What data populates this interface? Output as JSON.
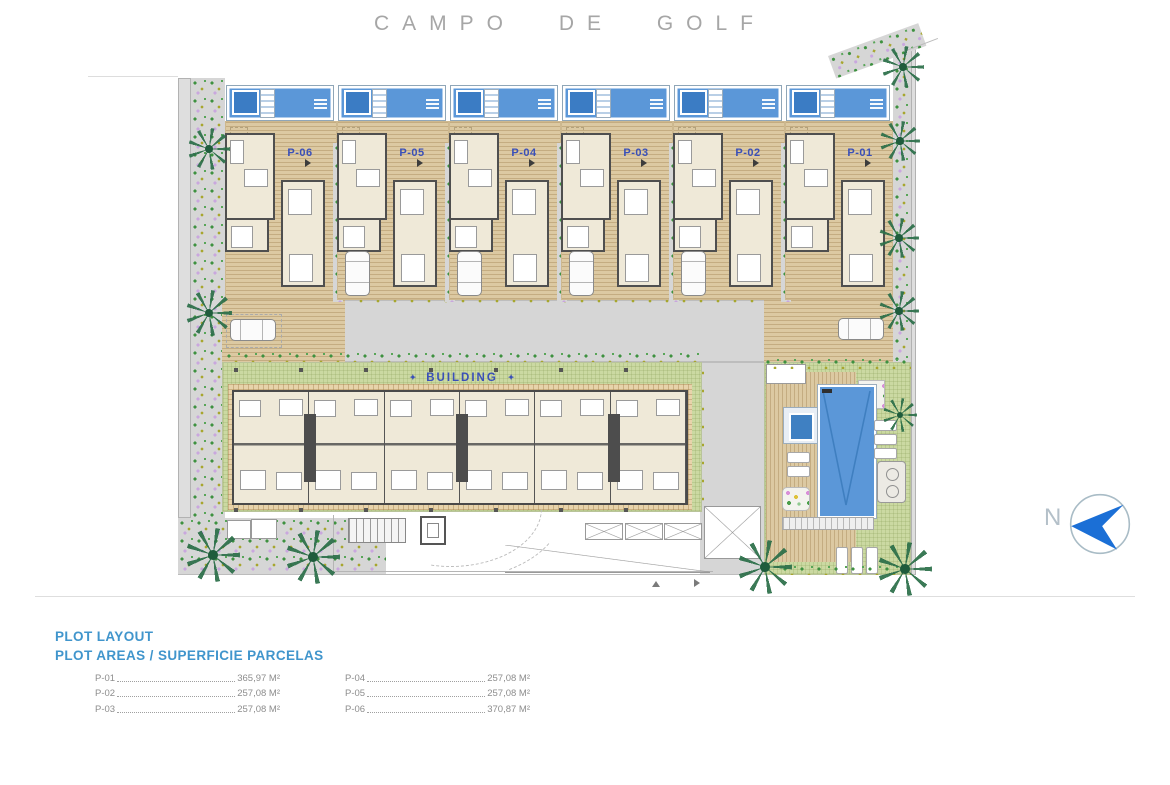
{
  "title": "CAMPO DE GOLF",
  "plots": [
    {
      "label": "P-06",
      "mods": [
        "no-car"
      ]
    },
    {
      "label": "P-05",
      "mods": []
    },
    {
      "label": "P-04",
      "mods": []
    },
    {
      "label": "P-03",
      "mods": []
    },
    {
      "label": "P-02",
      "mods": []
    },
    {
      "label": "P-01",
      "mods": [
        "no-car"
      ]
    }
  ],
  "building": {
    "label": "BUILDING",
    "decor": "✦"
  },
  "north": {
    "label": "N"
  },
  "legend": {
    "title": "PLOT LAYOUT",
    "subtitle": "PLOT AREAS / SUPERFICIE PARCELAS",
    "col1": [
      {
        "label": "P-01",
        "value": "365,97 M²"
      },
      {
        "label": "P-02",
        "value": "257,08 M²"
      },
      {
        "label": "P-03",
        "value": "257,08 M²"
      }
    ],
    "col2": [
      {
        "label": "P-04",
        "value": "257,08 M²"
      },
      {
        "label": "P-05",
        "value": "257,08 M²"
      },
      {
        "label": "P-06",
        "value": "370,87 M²"
      }
    ]
  },
  "colors": {
    "plot_label_blue": "#3a50b8",
    "legend_heading_blue": "#4095cc",
    "pool_blue": "#5b97d8",
    "spa_blue": "#3b7cc4",
    "deck_tan": "#dcc9a2",
    "lawn_green": "#cbd9a2",
    "house_cream": "#efe9d8",
    "road_gray": "#d6d6d6",
    "north_arrow_blue": "#1b6fd6"
  }
}
